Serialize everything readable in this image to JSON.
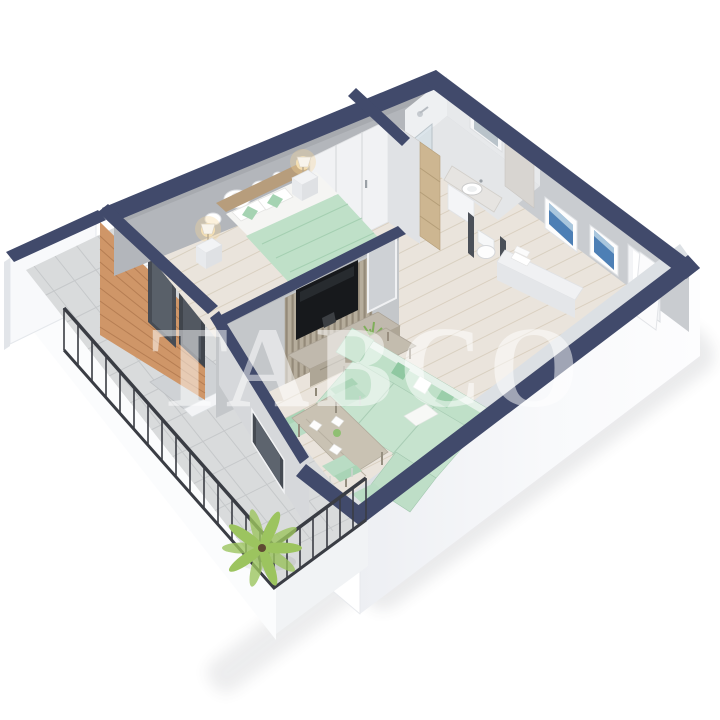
{
  "scene": {
    "watermark": "TABCO",
    "background": "#ffffff",
    "description": "3D isometric cutaway render of a one-bedroom apartment: bedroom with double bed and wardrobe, bathroom with shower and vanity, hallway with framed art and open door, living room with TV slat wall, mint sofa and dining set, and a tiled balcony with outdoor furniture, railing and palm plant"
  },
  "palette": {
    "wall_top": "#414a6b",
    "exterior": "#f7f8fa",
    "interior_wall": "#b3b6bb",
    "interior_wall_light": "#d6d8db",
    "floor_wood": "#eae4dc",
    "balcony_tile": "#d9dbdc",
    "brick": "#cf9668",
    "mint": "#bfe0c8",
    "mint_deep": "#a9d2b4",
    "wood_furniture": "#c0b9ad",
    "tv": "#17191c",
    "art_blue": "#4d7fb5",
    "lamp_glow": "#f6d79b",
    "plant": "#9cc45f",
    "railing": "#3a3d44",
    "marble": "#d8d5d1",
    "glass": "#cfdde6"
  }
}
